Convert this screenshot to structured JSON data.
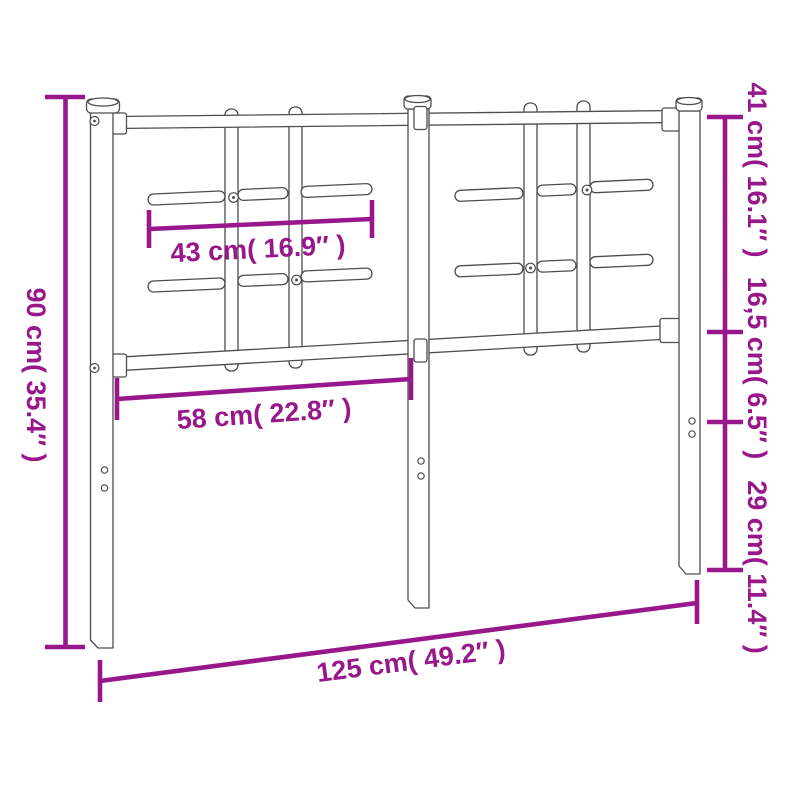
{
  "diagram": {
    "subject": "metal-headboard-dimension-diagram",
    "colors": {
      "dimension_color": "#98188C",
      "outline_color": "#4d4d4d",
      "background": "#ffffff"
    },
    "labels": {
      "overall_height": "90 cm( 35.4″ )",
      "upper_section_height": "41 cm( 16.1″ )",
      "middle_section_height": "16,5 cm( 6.5″ )",
      "lower_section_height": "29 cm( 11.4″ )",
      "slat_row_width": "43 cm( 16.9″ )",
      "panel_width": "58 cm( 22.8″ )",
      "overall_width": "125 cm( 49.2″ )"
    },
    "measurements": [
      {
        "cm": "90",
        "inches": "35.4",
        "placement": "left-vertical"
      },
      {
        "cm": "41",
        "inches": "16.1",
        "placement": "right-vertical-top"
      },
      {
        "cm": "16,5",
        "inches": "6.5",
        "placement": "right-vertical-middle"
      },
      {
        "cm": "29",
        "inches": "11.4",
        "placement": "right-vertical-bottom"
      },
      {
        "cm": "43",
        "inches": "16.9",
        "placement": "inner-upper"
      },
      {
        "cm": "58",
        "inches": "22.8",
        "placement": "inner-lower"
      },
      {
        "cm": "125",
        "inches": "49.2",
        "placement": "bottom-slanted"
      }
    ]
  }
}
